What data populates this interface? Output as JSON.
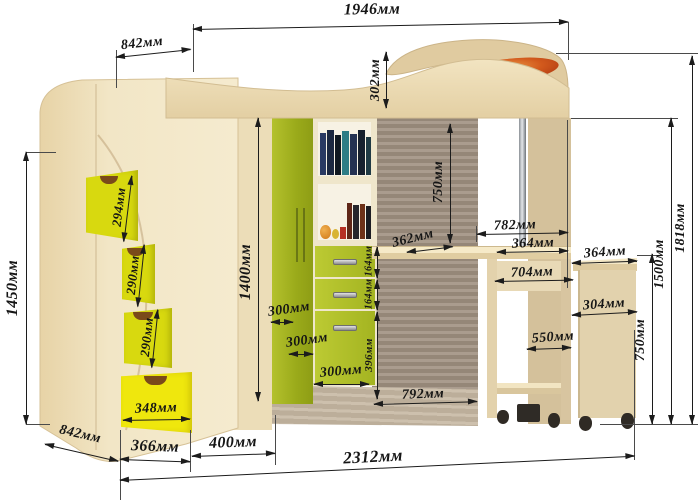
{
  "diagram_type": "furniture-dimension-drawing",
  "subject": "loft-bed with corner wardrobe, stairs, shelves and roll-out desk",
  "unit": "мм",
  "dims": {
    "total_width_top": "1946мм",
    "bed_depth_top": "842мм",
    "headboard_height": "302мм",
    "stairs_height": "1450мм",
    "step_1": "294мм",
    "step_2": "290мм",
    "step_3": "290мм",
    "stairs_drawer_width": "348мм",
    "stairs_depth_bottom": "842мм",
    "base_left_width": "366мм",
    "base_mid_width": "400мм",
    "total_length_bottom": "2312мм",
    "wardrobe_height": "1400мм",
    "door_width_1": "300мм",
    "door_width_2": "300мм",
    "door_width_3": "300мм",
    "drawer_height_1": "164мм",
    "drawer_height_2": "164мм",
    "drawer_height_3": "396мм",
    "underbed_clearance": "750мм",
    "desk_depth": "362мм",
    "desk_edge_782": "782мм",
    "desk_shelf_364": "364мм",
    "cart_top_364": "364мм",
    "desk_inner_704": "704мм",
    "cart_depth_304": "304мм",
    "desk_inner_550": "550мм",
    "desk_length_792": "792мм",
    "desk_height_750": "750мм",
    "rail_height_1500": "1500мм",
    "total_height_1818": "1818мм"
  },
  "colors": {
    "wood_light": "#f2e5c3",
    "wood_mid": "#e5d2a8",
    "wood_side": "#d8c49c",
    "panel_taupe": "#a09181",
    "green_door": "#a3b21f",
    "green_drawer": "#b5c42d",
    "yellow_step": "#d9d912",
    "yellow_drawer": "#efe60e",
    "orange_inlay": "#d96b1e",
    "dimension_ink": "#1c1c1c"
  }
}
